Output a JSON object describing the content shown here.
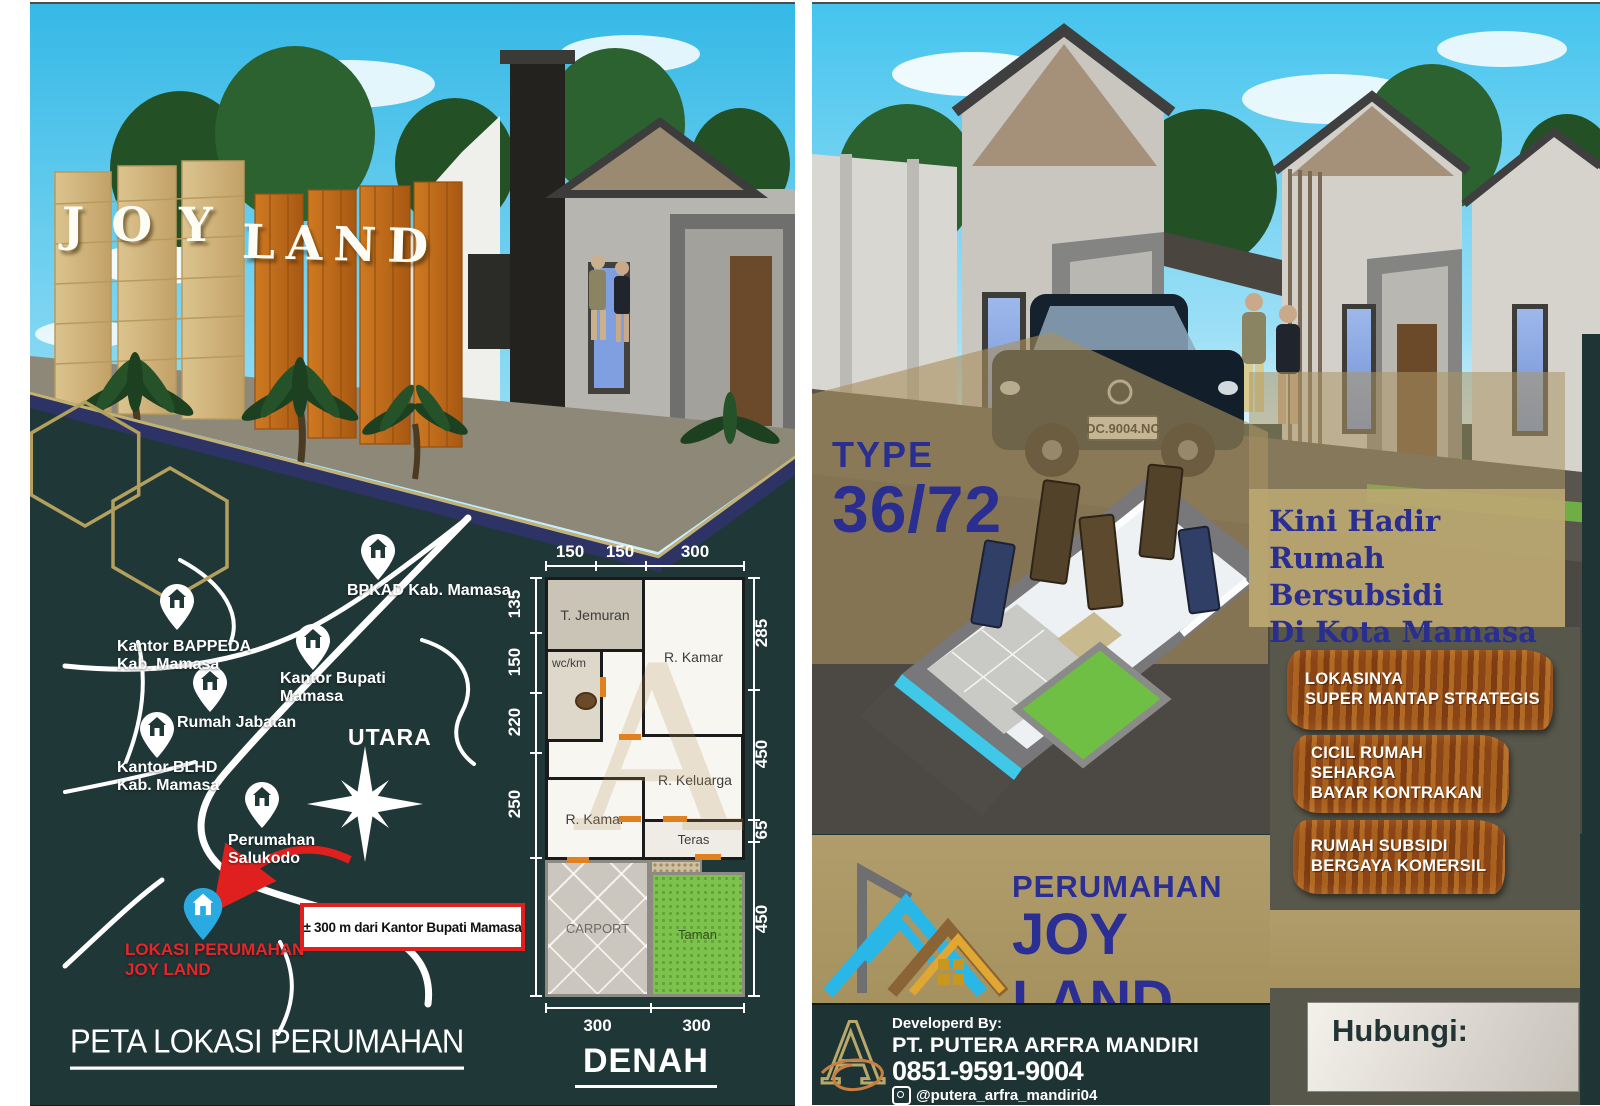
{
  "left_panel": {
    "sign": {
      "word1": "JOY",
      "word2": "LAND"
    },
    "map": {
      "title": "PETA LOKASI PERUMAHAN",
      "compass_label": "UTARA",
      "distance_note": "± 300 m dari Kantor Bupati Mamasa",
      "pins": [
        {
          "label": "BPKAD Kab. Mamasa"
        },
        {
          "label": "Kantor BAPPEDA\nKab. Mamasa"
        },
        {
          "label": "Kantor Bupati\nMamasa"
        },
        {
          "label": "Rumah Jabatan"
        },
        {
          "label": "Kantor BLHD\nKab. Mamasa"
        },
        {
          "label": "Perumahan\nSalukodo"
        },
        {
          "label": "LOKASI PERUMAHAN\nJOY LAND"
        }
      ]
    },
    "floorplan": {
      "title": "DENAH",
      "watermark": "A",
      "rooms": {
        "jemuran": "T. Jemuran",
        "kamar1": "R. Kamar",
        "wc": "wc/km",
        "keluarga": "R. Keluarga",
        "kamar2": "R. Kamar",
        "teras": "Teras",
        "carport": "CARPORT",
        "taman": "Taman"
      },
      "dims": {
        "top": [
          "150",
          "150",
          "300"
        ],
        "left": [
          "135",
          "150",
          "220",
          "250",
          "450"
        ],
        "right": [
          "285",
          "450",
          "65",
          "450"
        ],
        "bottom": [
          "300",
          "300"
        ]
      }
    }
  },
  "right_panel": {
    "type_label": "TYPE",
    "type_value": "36/72",
    "license_plate": "DC.9004.NC",
    "headline": "Kini Hadir Rumah\nBersubsidi\nDi Kota Mamasa",
    "signs": [
      "LOKASINYA\nSUPER MANTAP STRATEGIS",
      "CICIL RUMAH\nSEHARGA\nBAYAR KONTRAKAN",
      "RUMAH SUBSIDI\nBERGAYA KOMERSIL"
    ],
    "brand": {
      "line1": "PERUMAHAN",
      "line2": "JOY LAND"
    },
    "developer": {
      "by": "Developerd By:",
      "name": "PT. PUTERA ARFRA MANDIRI",
      "phone": "0851-9591-9004",
      "instagram": "@putera_arfra_mandiri04",
      "logo_letter": "A"
    },
    "contact_label": "Hubungi:"
  },
  "colors": {
    "accent_blue": "#2a2e90",
    "teal_bg": "#203737",
    "tan_band": "#ab9765",
    "olive": "#57574b",
    "wood": "#9c5a21",
    "red": "#e0201e",
    "pin_blue": "#29abe2"
  }
}
